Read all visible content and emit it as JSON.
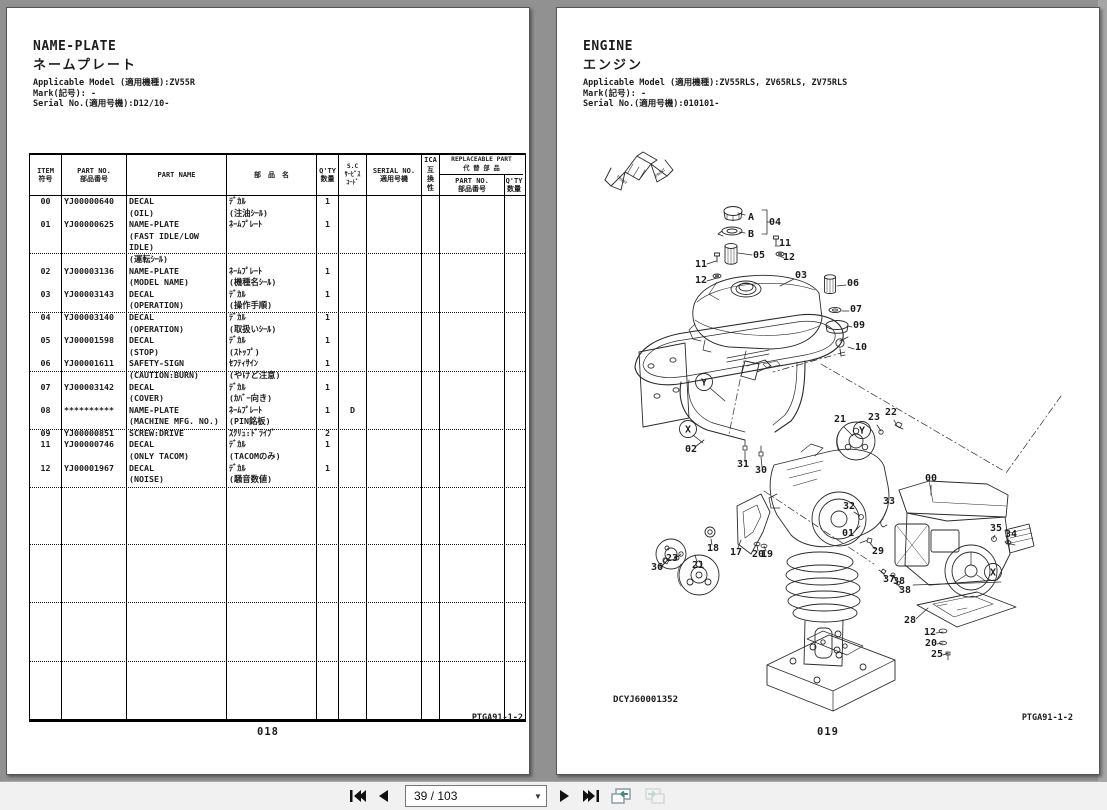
{
  "left_page": {
    "title_en": "NAME-PLATE",
    "title_jp": "ネームプレート",
    "meta": "Applicable Model (適用機種):ZV55R\nMark(記号): -\nSerial No.(適用号機):D12/10-",
    "doc_code": "PTGA91-1-2",
    "page_number": "018",
    "table": {
      "header": {
        "item": "ITEM\n符号",
        "part_no": "PART NO.\n部品番号",
        "part_name": "PART NAME",
        "part_name_jp": "部　品　名",
        "qty": "Q'TY\n数量",
        "sc": "S.C\nｻｰﾋﾞｽ\nｺｰﾄﾞ",
        "serial_no": "SERIAL NO.\n適用号機",
        "ica": "ICA\n互\n換\n性",
        "replaceable": "REPLACEABLE PART\n代 替 部 品",
        "repl_part_no": "PART NO.\n部品番号",
        "repl_qty": "Q'TY\n数量"
      },
      "rows": [
        {
          "item": "00",
          "part_no": "YJ00000640",
          "name": "DECAL\n(OIL)",
          "jp": "ﾃﾞｶﾙ\n(注油ｼｰﾙ)",
          "qty": "1",
          "sc": ""
        },
        {
          "item": "01",
          "part_no": "YJ00000625",
          "name": "NAME-PLATE\n(FAST IDLE/LOW IDLE)\n(運転ｼｰﾙ)",
          "jp": "ﾈｰﾑﾌﾟﾚｰﾄ",
          "qty": "1",
          "sc": ""
        },
        {
          "item": "02",
          "part_no": "YJ00003136",
          "name": "NAME-PLATE\n(MODEL NAME)",
          "jp": "ﾈｰﾑﾌﾟﾚｰﾄ\n(機種名ｼｰﾙ)",
          "qty": "1",
          "sc": ""
        },
        {
          "item": "03",
          "part_no": "YJ00003143",
          "name": "DECAL\n(OPERATION)",
          "jp": "ﾃﾞｶﾙ\n(操作手順)",
          "qty": "1",
          "sc": ""
        },
        {
          "item": "04",
          "part_no": "YJ00003140",
          "name": "DECAL\n(OPERATION)",
          "jp": "ﾃﾞｶﾙ\n(取扱いｼｰﾙ)",
          "qty": "1",
          "sc": ""
        },
        {
          "item": "05",
          "part_no": "YJ00001598",
          "name": "DECAL\n(STOP)",
          "jp": "ﾃﾞｶﾙ\n(ｽﾄｯﾌﾟ)",
          "qty": "1",
          "sc": ""
        },
        {
          "item": "06",
          "part_no": "YJ00001611",
          "name": "SAFETY-SIGN\n(CAUTION:BURN)",
          "jp": "ｾﾌﾃｨｻｲﾝ\n(やけど注意)",
          "qty": "1",
          "sc": ""
        },
        {
          "item": "07",
          "part_no": "YJ00003142",
          "name": "DECAL\n(COVER)",
          "jp": "ﾃﾞｶﾙ\n(ｶﾊﾞｰ向き)",
          "qty": "1",
          "sc": ""
        },
        {
          "item": "08",
          "part_no": "**********",
          "name": "NAME-PLATE\n(MACHINE MFG. NO.)",
          "jp": "ﾈｰﾑﾌﾟﾚｰﾄ\n(PIN銘板)",
          "qty": "1",
          "sc": "D"
        },
        {
          "item": "09",
          "part_no": "YJ00000851",
          "name": "SCREW:DRIVE",
          "jp": "ｽｸﾘｭ:ﾄﾞﾗｲﾌﾞ",
          "qty": "2",
          "sc": ""
        },
        {
          "item": "11",
          "part_no": "YJ00000746",
          "name": "DECAL\n(ONLY TACOM)",
          "jp": "ﾃﾞｶﾙ\n(TACOMのみ)",
          "qty": "1",
          "sc": ""
        },
        {
          "item": "12",
          "part_no": "YJ00001967",
          "name": "DECAL\n(NOISE)",
          "jp": "ﾃﾞｶﾙ\n(騒音数値)",
          "qty": "1",
          "sc": ""
        }
      ]
    }
  },
  "right_page": {
    "title_en": "ENGINE",
    "title_jp": "エンジン",
    "meta": "Applicable Model (適用機種):ZV55RLS, ZV65RLS, ZV75RLS\nMark(記号): -\nSerial No.(適用号機):010101-",
    "doc_code": "PTGA91-1-2",
    "page_number": "019",
    "figure_code": "DCYJ60001352",
    "front_label": "FRONT",
    "diagram": {
      "labels": [
        {
          "t": "A",
          "x": 174,
          "y": 86,
          "l": [
            168,
            81,
            161,
            79
          ]
        },
        {
          "t": "04",
          "x": 198,
          "y": 91
        },
        {
          "t": "B",
          "x": 174,
          "y": 103,
          "l": [
            168,
            99,
            162,
            98
          ]
        },
        {
          "t": "05",
          "x": 182,
          "y": 124,
          "l": [
            175,
            121,
            161,
            119
          ]
        },
        {
          "t": "11",
          "x": 208,
          "y": 112,
          "l": [
            203,
            112,
            198,
            112
          ]
        },
        {
          "t": "12",
          "x": 212,
          "y": 126,
          "l": [
            207,
            124,
            203,
            122
          ]
        },
        {
          "t": "03",
          "x": 224,
          "y": 144,
          "l": [
            217,
            145,
            203,
            152
          ]
        },
        {
          "t": "11",
          "x": 124,
          "y": 133,
          "l": [
            130,
            130,
            139,
            127
          ]
        },
        {
          "t": "12",
          "x": 124,
          "y": 149,
          "l": [
            130,
            147,
            140,
            144
          ]
        },
        {
          "t": "06",
          "x": 276,
          "y": 152,
          "l": [
            269,
            151,
            260,
            152
          ]
        },
        {
          "t": "07",
          "x": 279,
          "y": 178,
          "l": [
            272,
            177,
            265,
            177
          ]
        },
        {
          "t": "09",
          "x": 282,
          "y": 194,
          "l": [
            275,
            193,
            270,
            192
          ]
        },
        {
          "t": "10",
          "x": 284,
          "y": 216,
          "l": [
            277,
            215,
            271,
            213
          ]
        },
        {
          "t": "02",
          "x": 114,
          "y": 318,
          "l": [
            118,
            313,
            127,
            306
          ]
        },
        {
          "t": "31",
          "x": 166,
          "y": 333,
          "l": [
            168,
            327,
            168,
            317
          ]
        },
        {
          "t": "30",
          "x": 184,
          "y": 339,
          "l": [
            185,
            333,
            184,
            323
          ]
        },
        {
          "t": "21",
          "x": 263,
          "y": 288,
          "l": [
            267,
            293,
            276,
            302
          ]
        },
        {
          "t": "23",
          "x": 297,
          "y": 286,
          "l": [
            300,
            291,
            304,
            297
          ]
        },
        {
          "t": "22",
          "x": 314,
          "y": 281,
          "l": [
            317,
            286,
            320,
            292
          ]
        },
        {
          "t": "32",
          "x": 272,
          "y": 375,
          "l": [
            277,
            378,
            283,
            382
          ]
        },
        {
          "t": "01",
          "x": 271,
          "y": 402,
          "l": [
            277,
            398,
            283,
            392
          ]
        },
        {
          "t": "33",
          "x": 312,
          "y": 370,
          "l": [
            310,
            375,
            306,
            384
          ]
        },
        {
          "t": "00",
          "x": 354,
          "y": 347,
          "l": [
            354,
            351,
            354,
            361
          ]
        },
        {
          "t": "29",
          "x": 301,
          "y": 420,
          "l": [
            298,
            415,
            293,
            409
          ]
        },
        {
          "t": "35",
          "x": 419,
          "y": 397,
          "l": [
            418,
            401,
            416,
            405
          ]
        },
        {
          "t": "34",
          "x": 434,
          "y": 403,
          "l": [
            432,
            407,
            429,
            410
          ]
        },
        {
          "t": "37",
          "x": 312,
          "y": 448,
          "l": [
            309,
            444,
            306,
            439
          ]
        },
        {
          "t": "38",
          "x": 322,
          "y": 450,
          "l": [
            319,
            446,
            316,
            441
          ]
        },
        {
          "t": "38",
          "x": 328,
          "y": 459,
          "l": [
            324,
            455,
            320,
            449
          ]
        },
        {
          "t": "28",
          "x": 333,
          "y": 489,
          "l": [
            339,
            485,
            351,
            474
          ]
        },
        {
          "t": "12",
          "x": 353,
          "y": 501,
          "l": [
            359,
            499,
            366,
            498
          ]
        },
        {
          "t": "20",
          "x": 354,
          "y": 512,
          "l": [
            360,
            510,
            366,
            509
          ]
        },
        {
          "t": "25",
          "x": 360,
          "y": 523,
          "l": [
            366,
            521,
            371,
            519
          ]
        },
        {
          "t": "36",
          "x": 80,
          "y": 436,
          "l": [
            84,
            432,
            89,
            428
          ]
        },
        {
          "t": "23",
          "x": 95,
          "y": 427,
          "l": [
            99,
            424,
            104,
            420
          ]
        },
        {
          "t": "21",
          "x": 121,
          "y": 434,
          "l": [
            120,
            428,
            118,
            421
          ]
        },
        {
          "t": "18",
          "x": 136,
          "y": 417,
          "l": [
            135,
            411,
            134,
            405
          ]
        },
        {
          "t": "17",
          "x": 159,
          "y": 421,
          "l": [
            161,
            414,
            164,
            406
          ]
        },
        {
          "t": "20",
          "x": 181,
          "y": 423,
          "l": [
            181,
            417,
            180,
            411
          ]
        },
        {
          "t": "19",
          "x": 190,
          "y": 423,
          "l": [
            189,
            417,
            187,
            412
          ]
        }
      ],
      "circled": [
        {
          "t": "Y",
          "x": 127,
          "y": 248,
          "l": [
            133,
            254,
            148,
            267
          ]
        },
        {
          "t": "X",
          "x": 111,
          "y": 295,
          "l": [
            116,
            301,
            126,
            309
          ]
        },
        {
          "t": "Y",
          "x": 285,
          "y": 296
        },
        {
          "t": "X",
          "x": 416,
          "y": 438
        }
      ]
    }
  },
  "toolbar": {
    "page_indicator": "39 / 103",
    "buttons": {
      "first": "first-page",
      "prev": "previous-page",
      "next": "next-page",
      "last": "last-page",
      "back": "navigate-back",
      "forward": "navigate-forward"
    }
  }
}
